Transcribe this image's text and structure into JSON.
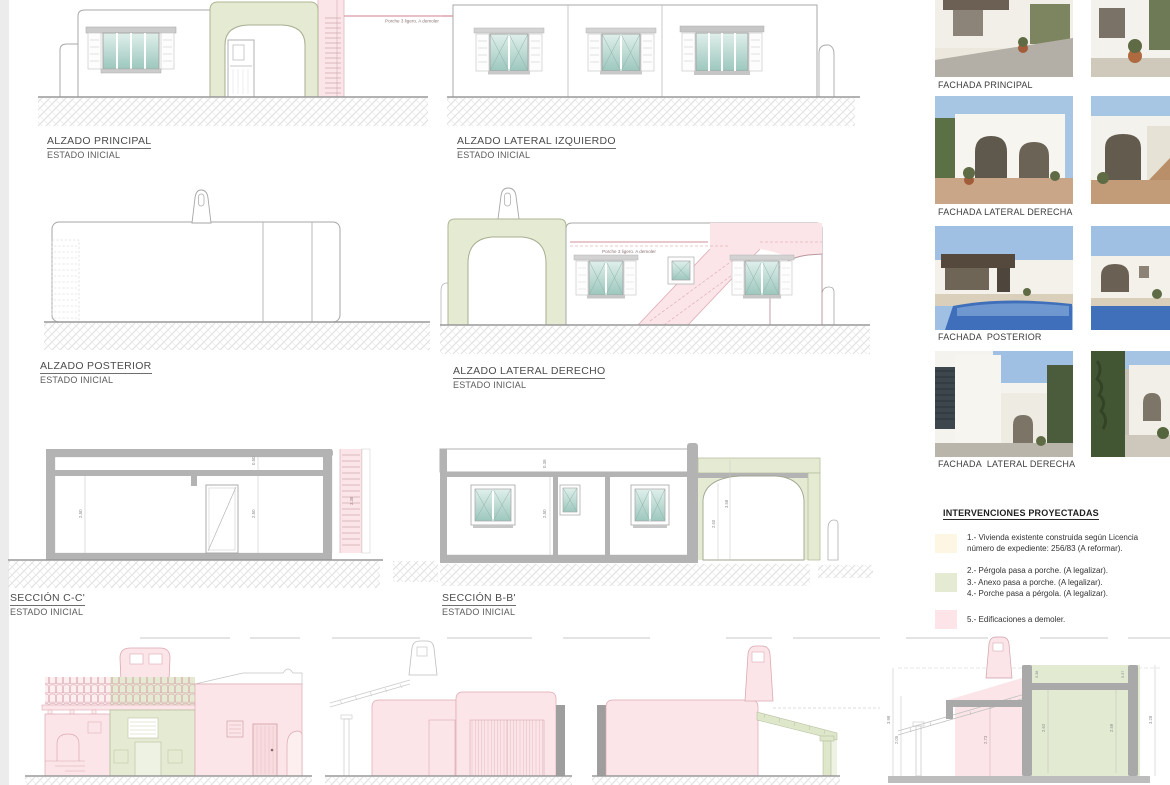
{
  "panels": [
    {
      "title": "ALZADO PRINCIPAL",
      "subtitle": "ESTADO INICIAL"
    },
    {
      "title": "ALZADO LATERAL IZQUIERDO",
      "subtitle": "ESTADO INICIAL"
    },
    {
      "title": "ALZADO POSTERIOR",
      "subtitle": "ESTADO INICIAL"
    },
    {
      "title": "ALZADO LATERAL DERECHO",
      "subtitle": "ESTADO INICIAL"
    },
    {
      "title": "SECCIÓN C-C'",
      "subtitle": "ESTADO INICIAL"
    },
    {
      "title": "SECCIÓN B-B'",
      "subtitle": "ESTADO INICIAL"
    }
  ],
  "annotations": {
    "porche_demoler": "Porche 3 ligero. A demoler"
  },
  "photos": [
    {
      "caption": "FACHADA PRINCIPAL"
    },
    {
      "caption": "FACHADA LATERAL DERECHA"
    },
    {
      "caption": "FACHADA  POSTERIOR"
    },
    {
      "caption": "FACHADA  LATERAL DERECHA"
    }
  ],
  "legend": {
    "heading": "INTERVENCIONES PROYECTADAS",
    "items": [
      {
        "swatch": "#fcf6e2",
        "lines": [
          "1.- Vivienda existente construida según Licencia",
          "número de expediente: 256/83 (A reformar)."
        ]
      },
      {
        "swatch": "#e4ebd2",
        "lines": [
          "2.- Pérgola pasa a porche. (A legalizar).",
          "3.- Anexo pasa a porche. (A legalizar).",
          "4.- Porche pasa a pérgola. (A legalizar)."
        ]
      },
      {
        "swatch": "#fce4e8",
        "lines": [
          "5.- Edificaciones a demoler."
        ]
      }
    ]
  },
  "dimensions": {
    "cc_wall": "2.50",
    "cc_wall2": "2.50",
    "cc_roof": "0.50",
    "cc_stair": "3.38",
    "bb_roof": "0.38",
    "bb_wall": "2.50",
    "bb_arch": "2.60",
    "bb_porch": "3.58",
    "s4_left_outer": "3.98",
    "s4_left_inner": "2.05",
    "s4_pink": "2.73",
    "s4_green_left": "2.62",
    "s4_green_right": "2.59",
    "s4_right_outer": "3.28",
    "s4_slab_left": "0.38",
    "s4_slab_right": "0.37"
  },
  "colors": {
    "pink": "#fbe5e8",
    "green": "#e5ebd3",
    "glass": "#9cc7bd",
    "wall_gray": "#b3b3b3"
  }
}
